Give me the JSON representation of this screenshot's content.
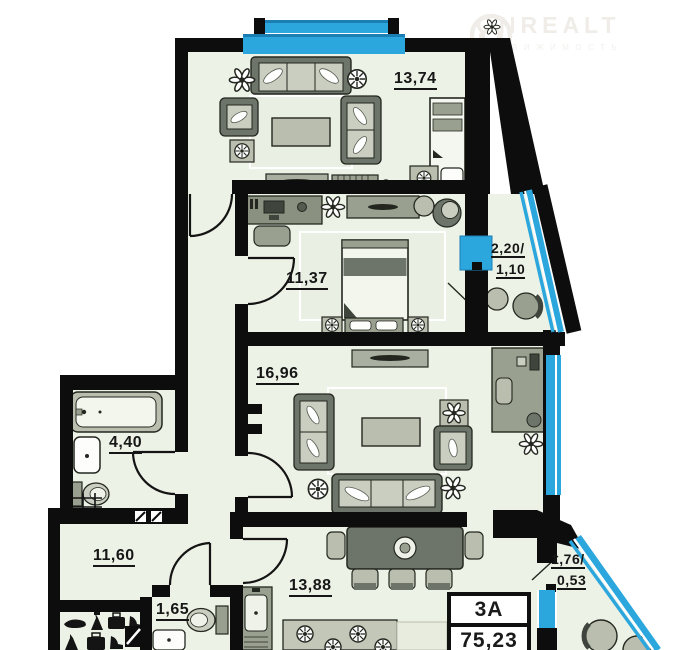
{
  "watermark": {
    "brand": "ONREALT",
    "tagline": "НЕДВИЖИМОСТЬ"
  },
  "rooms": {
    "living_top": "13,74",
    "bedroom": "11,37",
    "balcony_top_l1": "2,20/",
    "balcony_top_l2": "1,10",
    "living_main": "16,96",
    "bathroom": "4,40",
    "hallway": "11,60",
    "wc": "1,65",
    "kitchen": "13,88",
    "balcony_bottom_l1": "1,76/",
    "balcony_bottom_l2": "0,53"
  },
  "info_box": {
    "unit_type": "3А",
    "total_area": "75,23"
  },
  "colors": {
    "wall": "#0d0d0d",
    "floor": "#edf2e6",
    "window_blue": "#2ba7de",
    "window_blue_dark": "#1b7fb4"
  }
}
